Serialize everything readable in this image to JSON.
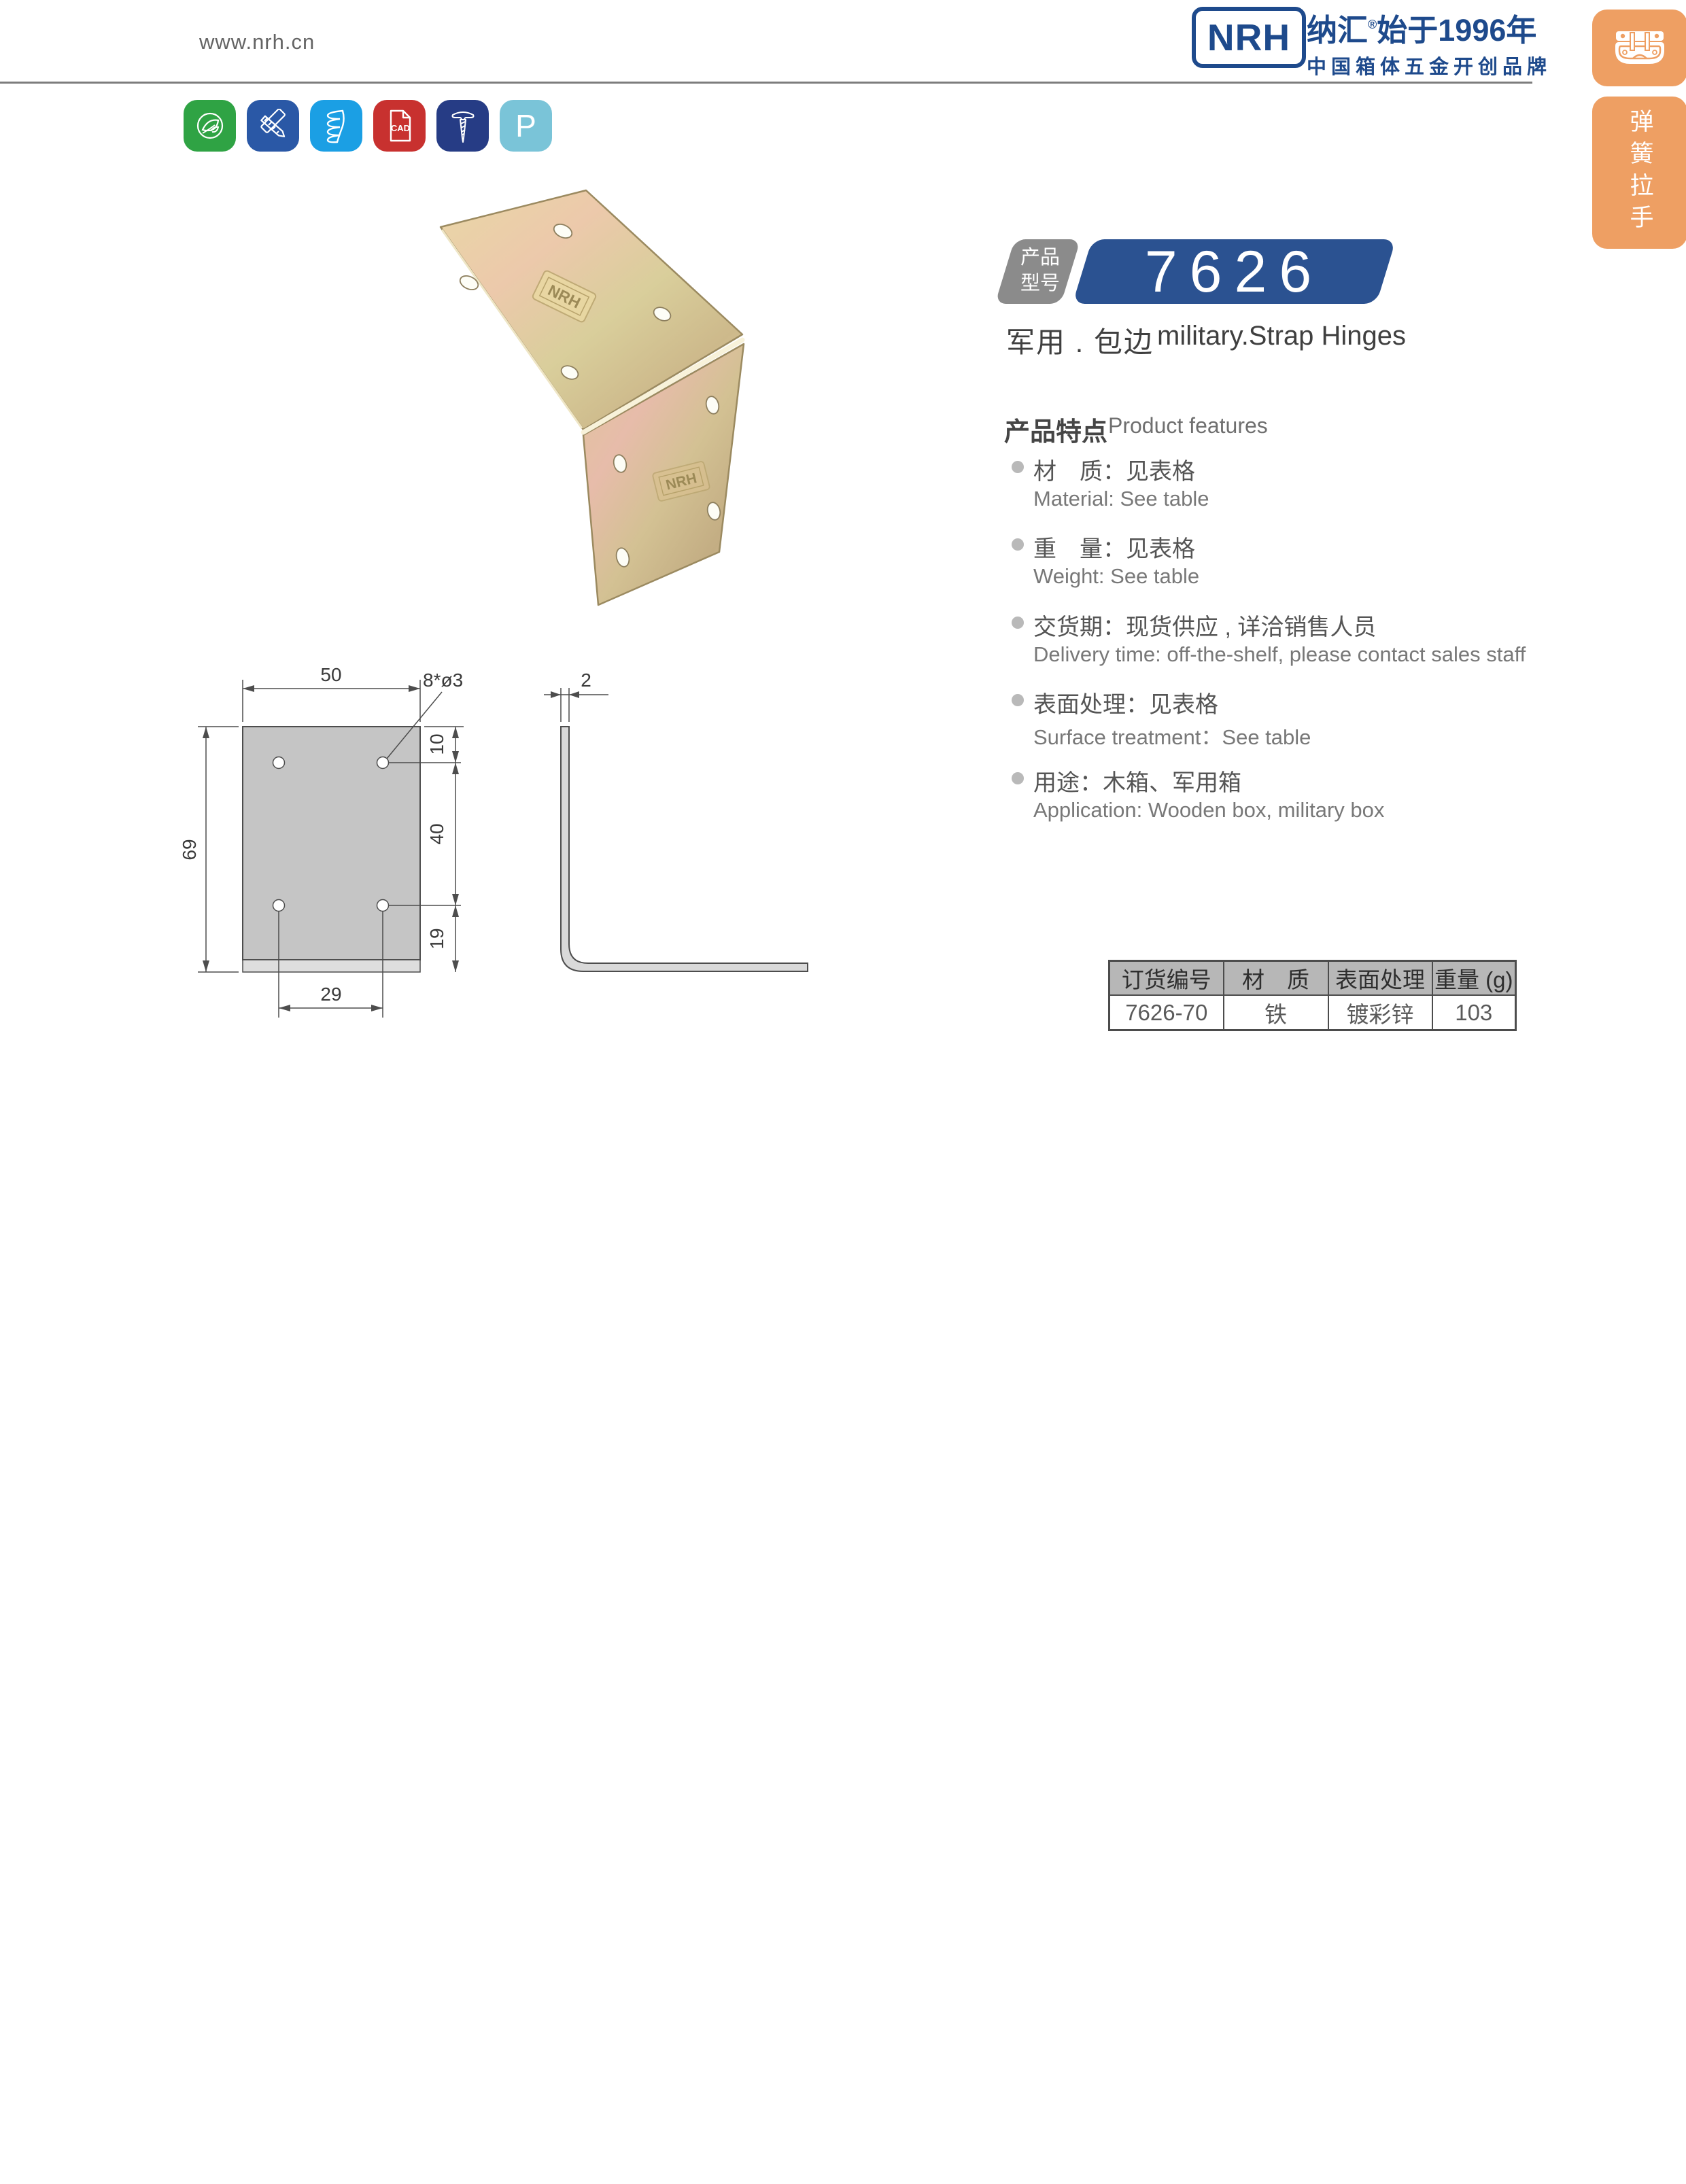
{
  "header": {
    "url": "www.nrh.cn"
  },
  "logo": {
    "mark": "NRH",
    "brand": "纳汇",
    "reg": "®",
    "since": "始于1996年",
    "subtitle": "中国箱体五金开创品牌",
    "brand_color": "#1e4a8c"
  },
  "sidebar": {
    "accent_color": "#ee9f63",
    "tabs": [
      {
        "icon": "latch-icon",
        "label": ""
      },
      {
        "icon": "",
        "label": "弹簧拉手"
      }
    ]
  },
  "feature_icons": {
    "items": [
      {
        "name": "eco-leaf-icon",
        "color": "#2fa344",
        "label": ""
      },
      {
        "name": "design-tools-icon",
        "color": "#2a58a6",
        "label": ""
      },
      {
        "name": "spring-icon",
        "color": "#1b9fe4",
        "label": ""
      },
      {
        "name": "cad-file-icon",
        "color": "#c8312f",
        "label": "CAD"
      },
      {
        "name": "screw-icon",
        "color": "#263c85",
        "label": ""
      },
      {
        "name": "letter-p-icon",
        "color": "#7ac4d8",
        "label": "P"
      }
    ]
  },
  "product": {
    "badge_line1": "产品",
    "badge_line2": "型号",
    "model": "7626",
    "model_badge_color": "#2b5291",
    "category_cn": "军用 . 包边",
    "category_en": "military.Strap Hinges"
  },
  "features": {
    "title_cn": "产品特点",
    "title_en": "Product features",
    "items": [
      {
        "cn": "材　质：见表格",
        "en": "Material: See table"
      },
      {
        "cn": "重　量：见表格",
        "en": "Weight: See table"
      },
      {
        "cn": "交货期：现货供应 , 详洽销售人员",
        "en": "Delivery time: off-the-shelf, please contact sales staff"
      },
      {
        "cn": "表面处理：见表格",
        "en": "Surface treatment：See table"
      },
      {
        "cn": "用途：木箱、军用箱",
        "en": "Application: Wooden box, military box"
      }
    ]
  },
  "drawing": {
    "width50": "50",
    "holes": "8*ø3",
    "thickness": "2",
    "seg10": "10",
    "seg40": "40",
    "seg19": "19",
    "height69": "69",
    "span29": "29"
  },
  "table": {
    "headers": [
      "订货编号",
      "材　质",
      "表面处理",
      "重量 (g)"
    ],
    "rows": [
      [
        "7626-70",
        "铁",
        "镀彩锌",
        "103"
      ]
    ]
  }
}
